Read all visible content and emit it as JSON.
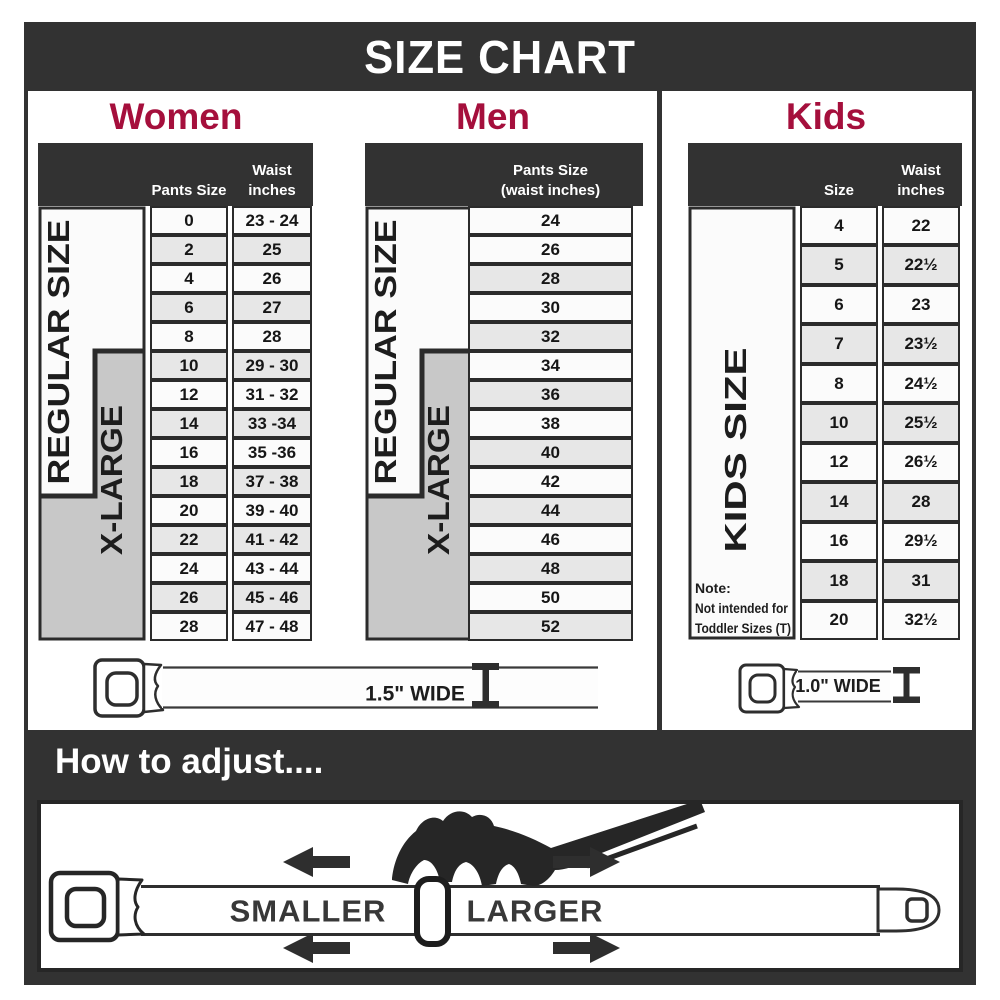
{
  "title": "SIZE CHART",
  "colors": {
    "header_bar": "#323232",
    "accent_red": "#A50F3C",
    "row_shaded": "#e7e7e7",
    "label_gray": "#c8c8c8"
  },
  "women": {
    "heading": "Women",
    "col1_header": "Pants Size",
    "col2_header_line1": "Waist",
    "col2_header_line2": "inches",
    "regular_label": "REGULAR SIZE",
    "xlarge_label": "X-LARGE",
    "rows": [
      {
        "size": "0",
        "waist": "23 - 24"
      },
      {
        "size": "2",
        "waist": "25"
      },
      {
        "size": "4",
        "waist": "26"
      },
      {
        "size": "6",
        "waist": "27"
      },
      {
        "size": "8",
        "waist": "28"
      },
      {
        "size": "10",
        "waist": "29 - 30"
      },
      {
        "size": "12",
        "waist": "31 - 32"
      },
      {
        "size": "14",
        "waist": "33 -34"
      },
      {
        "size": "16",
        "waist": "35 -36"
      },
      {
        "size": "18",
        "waist": "37 - 38"
      },
      {
        "size": "20",
        "waist": "39 - 40"
      },
      {
        "size": "22",
        "waist": "41 - 42"
      },
      {
        "size": "24",
        "waist": "43 - 44"
      },
      {
        "size": "26",
        "waist": "45 - 46"
      },
      {
        "size": "28",
        "waist": "47 - 48"
      }
    ],
    "belt_label": "1.5\" WIDE"
  },
  "men": {
    "heading": "Men",
    "col_header_line1": "Pants Size",
    "col_header_line2": "(waist inches)",
    "regular_label": "REGULAR SIZE",
    "xlarge_label": "X-LARGE",
    "rows": [
      "24",
      "26",
      "28",
      "30",
      "32",
      "34",
      "36",
      "38",
      "40",
      "42",
      "44",
      "46",
      "48",
      "50",
      "52"
    ]
  },
  "kids": {
    "heading": "Kids",
    "col1_header": "Size",
    "col2_header_line1": "Waist",
    "col2_header_line2": "inches",
    "label": "KIDS SIZE",
    "note_line1": "Note:",
    "note_line2": "Not intended for",
    "note_line3": "Toddler Sizes (T)",
    "rows": [
      {
        "size": "4",
        "waist": "22"
      },
      {
        "size": "5",
        "waist": "22½"
      },
      {
        "size": "6",
        "waist": "23"
      },
      {
        "size": "7",
        "waist": "23½"
      },
      {
        "size": "8",
        "waist": "24½"
      },
      {
        "size": "10",
        "waist": "25½"
      },
      {
        "size": "12",
        "waist": "26½"
      },
      {
        "size": "14",
        "waist": "28"
      },
      {
        "size": "16",
        "waist": "29½"
      },
      {
        "size": "18",
        "waist": "31"
      },
      {
        "size": "20",
        "waist": "32½"
      }
    ],
    "belt_label": "1.0\" WIDE"
  },
  "adjust": {
    "heading": "How to adjust....",
    "smaller_label": "SMALLER",
    "larger_label": "LARGER"
  }
}
